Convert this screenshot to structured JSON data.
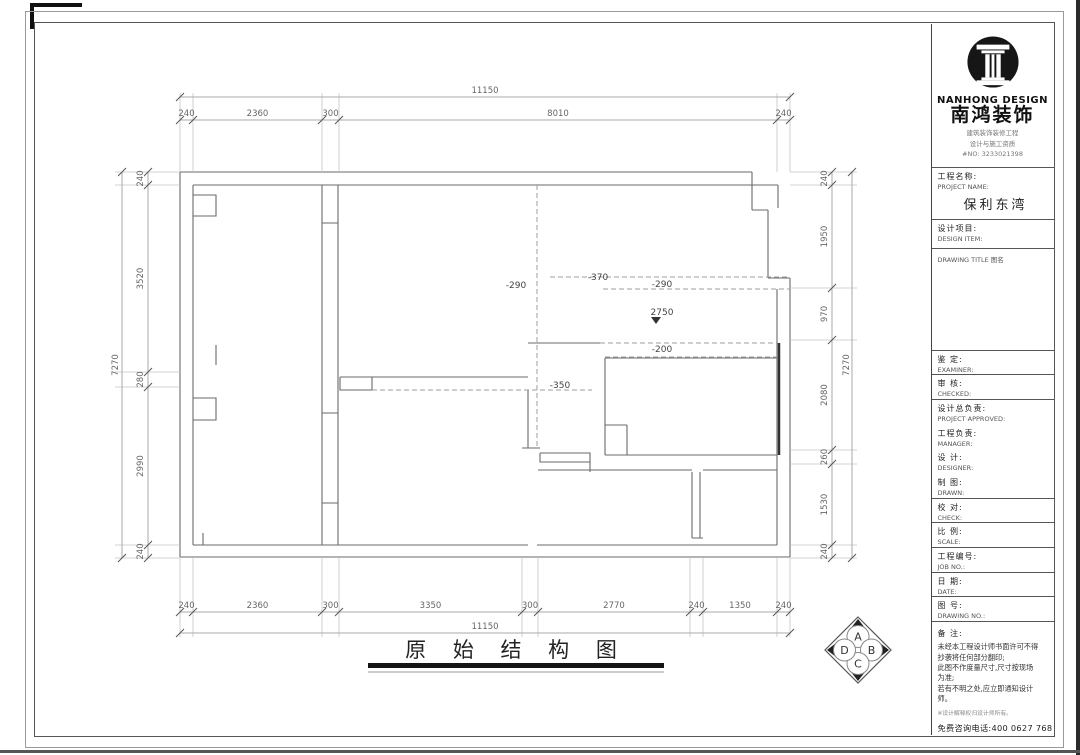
{
  "sheet": {
    "drawing_title": "原 始 结 构 图",
    "compass": {
      "top": "A",
      "right": "B",
      "bottom": "C",
      "left": "D"
    }
  },
  "dims": {
    "top": {
      "total": "11150",
      "segs": [
        "240",
        "2360",
        "300",
        "8010",
        "240"
      ]
    },
    "bottom": {
      "total": "11150",
      "segs": [
        "240",
        "2360",
        "300",
        "3350",
        "300",
        "2770",
        "240",
        "1350",
        "240"
      ]
    },
    "left": {
      "total": "7270",
      "segs": [
        "240",
        "3520",
        "280",
        "2990",
        "240"
      ]
    },
    "right": {
      "total": "7270",
      "segs": [
        "240",
        "1950",
        "970",
        "2080",
        "260",
        "1530",
        "240"
      ]
    },
    "levels": [
      "-290",
      "-370",
      "-290",
      "2750",
      "-200",
      "-350"
    ]
  },
  "titleblock": {
    "brand": {
      "logo_en": "NANHONG DESIGN",
      "logo_cn": "南鸿装饰",
      "cert_line1": "建筑装饰装修工程",
      "cert_line2": "设计与施工资质",
      "cert_no": "#NO: 3233021398"
    },
    "project": {
      "label_cn": "工程名称:",
      "label_en": "PROJECT NAME:",
      "value": "保利东湾"
    },
    "design_item": {
      "label_cn": "设计项目:",
      "label_en": "DESIGN ITEM:"
    },
    "drawing_title_label": "DRAWING TITLE 图名",
    "fields": {
      "examiner": {
        "cn": "鉴  定:",
        "en": "EXAMINER:"
      },
      "checked": {
        "cn": "审  核:",
        "en": "CHECKED:"
      },
      "project_approved": {
        "cn": "设计总负责:",
        "en": "PROJECT APPROVED:"
      },
      "manager": {
        "cn": "工程负责:",
        "en": "MANAGER:"
      },
      "designer": {
        "cn": "设  计:",
        "en": "DESIGNER:"
      },
      "drawn": {
        "cn": "制  图:",
        "en": "DRAWN:"
      },
      "check": {
        "cn": "校  对:",
        "en": "CHECK:"
      },
      "scale": {
        "cn": "比  例:",
        "en": "SCALE:"
      },
      "job_no": {
        "cn": "工程编号:",
        "en": "JOB NO.:"
      },
      "date": {
        "cn": "日  期:",
        "en": "DATE:"
      },
      "drawing_no": {
        "cn": "图  号:",
        "en": "DRAWING NO.:"
      }
    },
    "remark": {
      "label": "备  注:",
      "lines": [
        "未经本工程设计师书面许可不得",
        "抄袭将任何部分翻印;",
        "此图不作度量尺寸,尺寸按现场",
        "为准;",
        "若有不明之处,应立即通知设计",
        "师。"
      ],
      "note": "※设计解释权归设计师所有。",
      "phone": "免费咨询电话:400 0627 768"
    }
  }
}
